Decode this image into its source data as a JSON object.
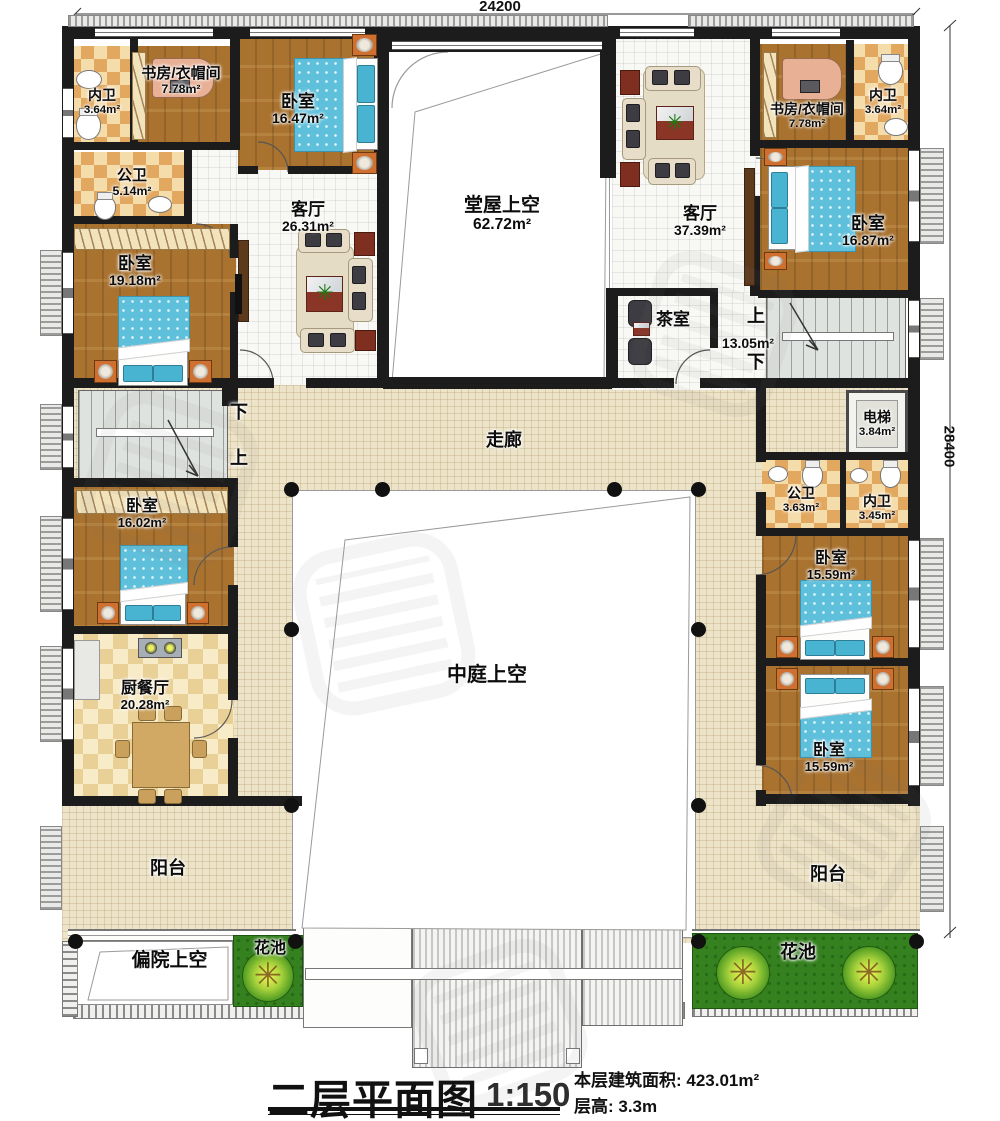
{
  "dimensions": {
    "width_label": "24200",
    "height_label": "28400"
  },
  "rooms": {
    "neiwei_tl": {
      "name": "内卫",
      "area": "3.64m²"
    },
    "shufang_tl": {
      "name": "书房/衣帽间",
      "area": "7.78m²"
    },
    "woshi_tl": {
      "name": "卧室",
      "area": "16.47m²"
    },
    "gongwei_tl": {
      "name": "公卫",
      "area": "5.14m²"
    },
    "keting_l": {
      "name": "客厅",
      "area": "26.31m²"
    },
    "woshi_l": {
      "name": "卧室",
      "area": "19.18m²"
    },
    "tangwu": {
      "name": "堂屋上空",
      "area": "62.72m²"
    },
    "keting_r": {
      "name": "客厅",
      "area": "37.39m²"
    },
    "shufang_tr": {
      "name": "书房/衣帽间",
      "area": "7.78m²"
    },
    "neiwei_tr": {
      "name": "内卫",
      "area": "3.64m²"
    },
    "woshi_tr": {
      "name": "卧室",
      "area": "16.87m²"
    },
    "chashi": {
      "name": "茶室",
      "area": "13.05m²"
    },
    "dianti": {
      "name": "电梯",
      "area": "3.84m²"
    },
    "gongwei_r": {
      "name": "公卫",
      "area": "3.63m²"
    },
    "neiwei_r": {
      "name": "内卫",
      "area": "3.45m²"
    },
    "woshi_r1": {
      "name": "卧室",
      "area": "15.59m²"
    },
    "woshi_r2": {
      "name": "卧室",
      "area": "15.59m²"
    },
    "woshi_l2": {
      "name": "卧室",
      "area": "16.02m²"
    },
    "chucanting": {
      "name": "厨餐厅",
      "area": "20.28m²"
    },
    "zoulang": {
      "name": "走廊"
    },
    "zhongting": {
      "name": "中庭上空"
    },
    "yangtai_l": {
      "name": "阳台"
    },
    "yangtai_r": {
      "name": "阳台"
    },
    "pianyuan": {
      "name": "偏院上空"
    },
    "huachi_l": {
      "name": "花池"
    },
    "huachi_r": {
      "name": "花池"
    }
  },
  "stairs": {
    "up": "上",
    "down": "下"
  },
  "title": {
    "main": "二层平面图",
    "scale": "1:150",
    "info_area": "本层建筑面积: 423.01m²",
    "info_height": "层高: 3.3m"
  }
}
